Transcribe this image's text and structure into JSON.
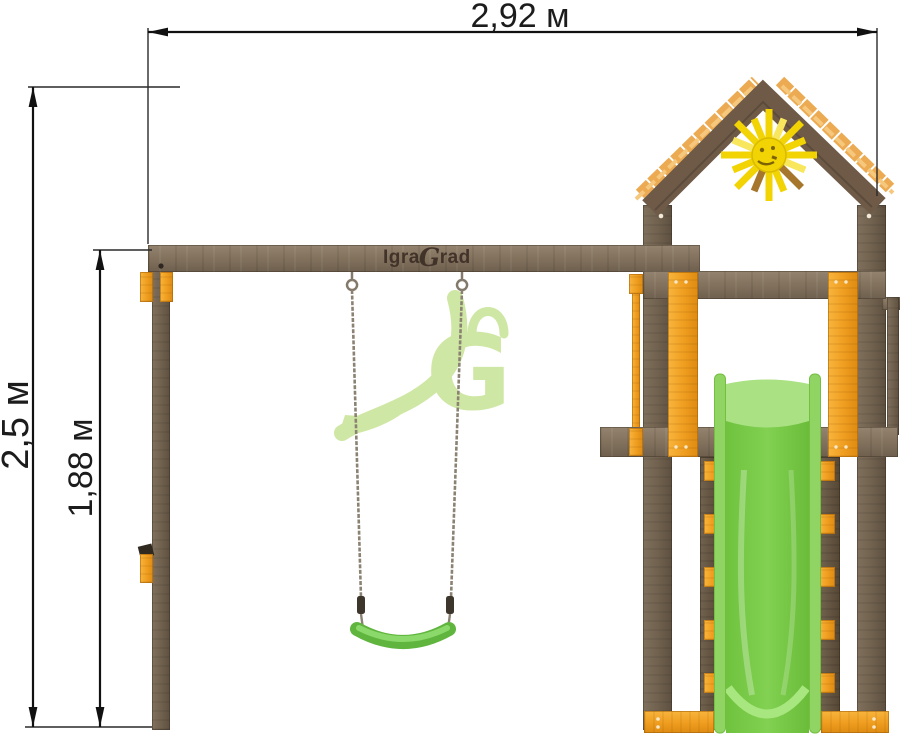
{
  "diagram": {
    "subject": "playground swing set with tower and slide, front elevation with dimensions"
  },
  "dimensions": {
    "width_label": "2,92 м",
    "overall_height_label": "2,5 м",
    "frame_height_label": "1,88 м"
  },
  "brand": {
    "name": "IgraGrad",
    "logo_prefix": "Igra",
    "logo_initial": "G",
    "logo_suffix": "rad",
    "watermark_initial": "G"
  },
  "colors": {
    "wood_brown": "#7d6e5c",
    "accent_orange": "#ef9d1f",
    "slide_green": "#7ccb4b",
    "seat_green": "#6fc24a",
    "sun_yellow": "#f2d303",
    "watermark_green": "#cfe7a4",
    "dimension_line": "#1c1c1c",
    "background": "#ffffff"
  }
}
